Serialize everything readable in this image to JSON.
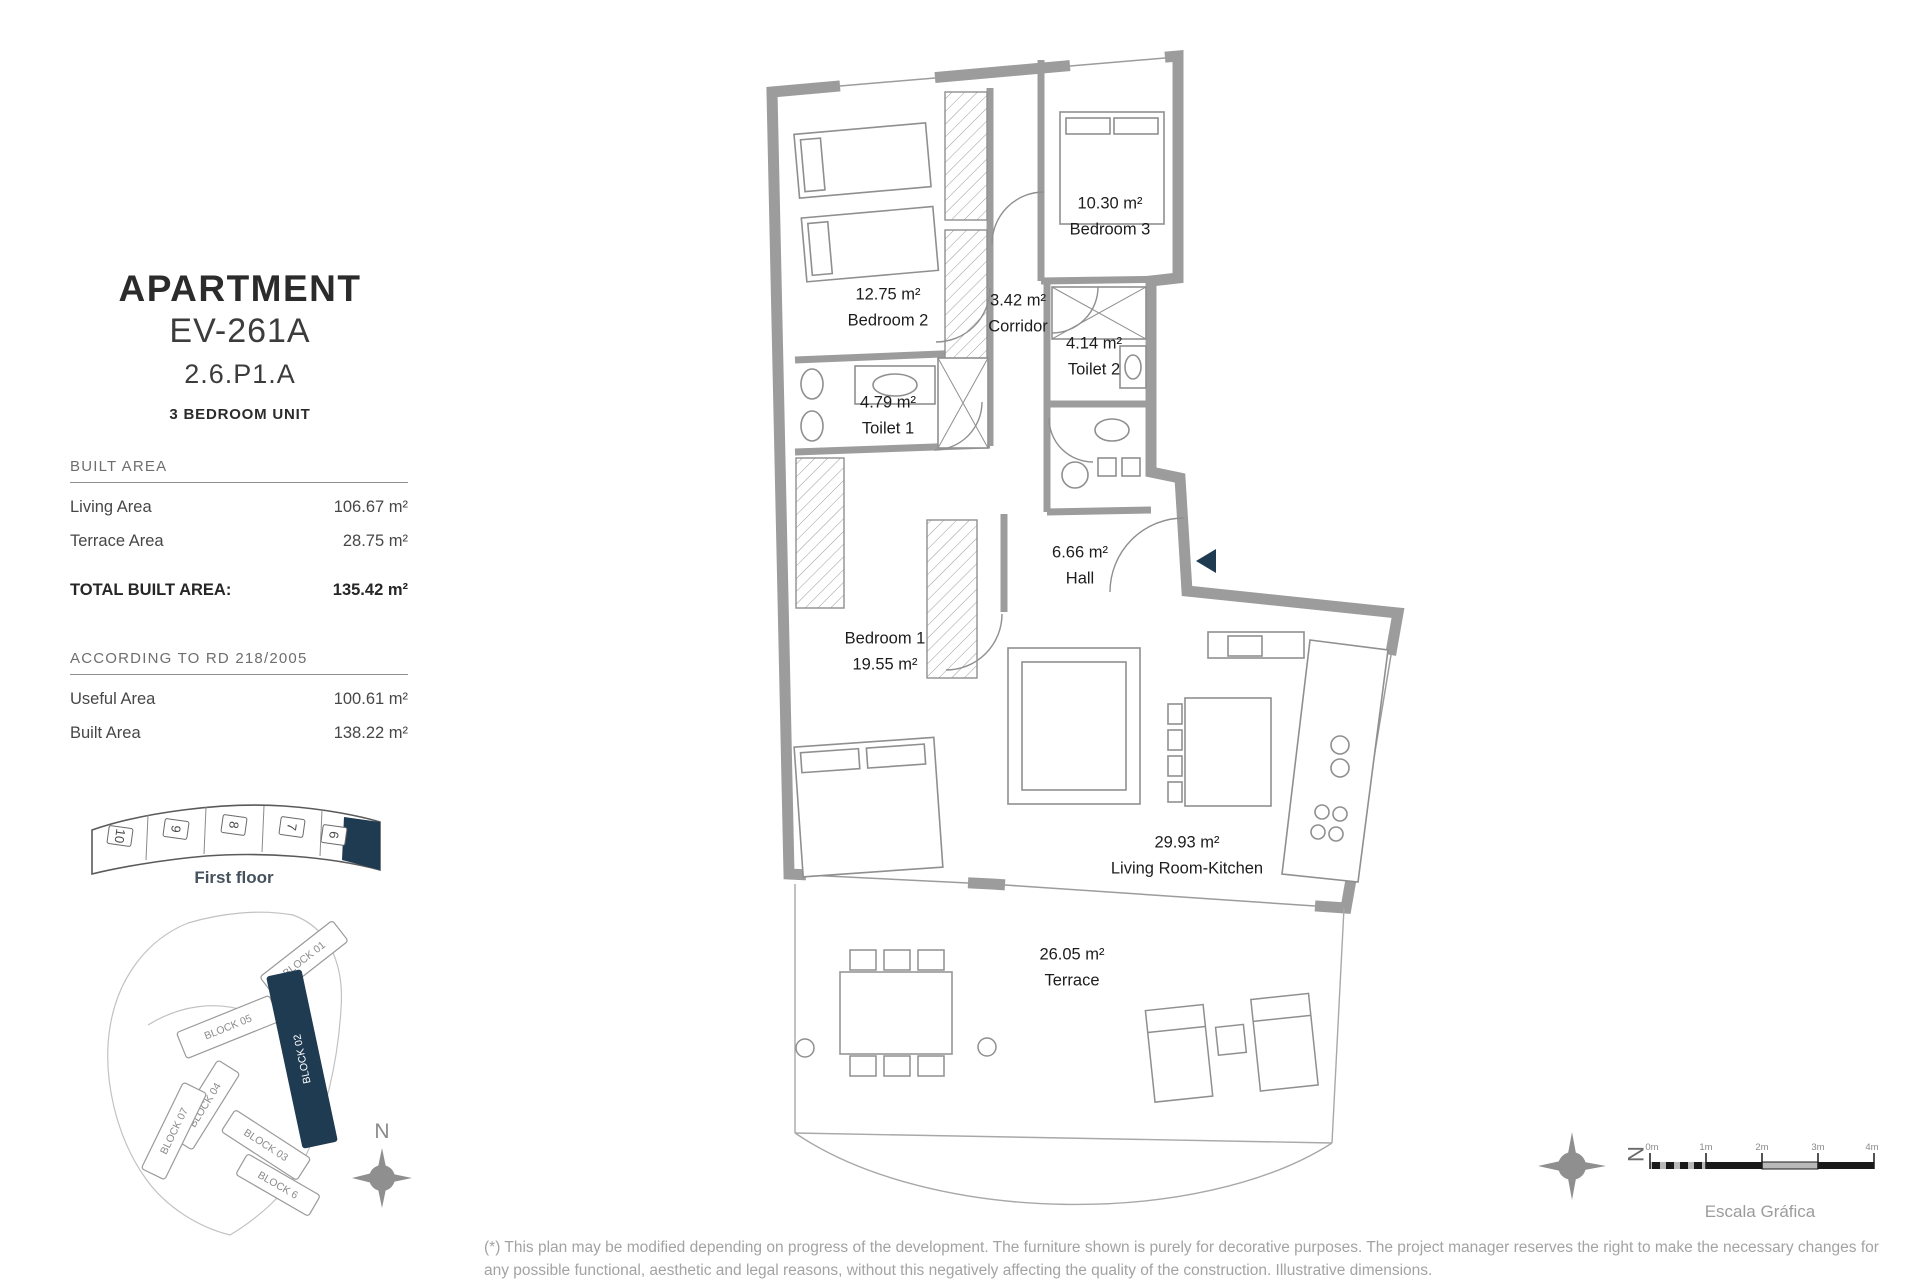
{
  "sidebar": {
    "title": "APARTMENT",
    "unit_code": "EV-261A",
    "unit_ref": "2.6.P1.A",
    "unit_type": "3 BEDROOM UNIT",
    "built_area": {
      "heading": "BUILT AREA",
      "rows": [
        {
          "label": "Living Area",
          "value": "106.67 m²"
        },
        {
          "label": "Terrace Area",
          "value": "28.75 m²"
        }
      ],
      "total_label": "TOTAL BUILT AREA:",
      "total_value": "135.42 m²"
    },
    "rd_area": {
      "heading": "ACCORDING TO RD 218/2005",
      "rows": [
        {
          "label": "Useful Area",
          "value": "100.61 m²"
        },
        {
          "label": "Built Area",
          "value": "138.22 m²"
        }
      ]
    },
    "floor_strip": {
      "caption": "First floor",
      "units": [
        "10",
        "9",
        "8",
        "7",
        "6"
      ],
      "highlighted_unit": "6"
    },
    "site_map": {
      "blocks": [
        "BLOCK 01",
        "BLOCK 02",
        "BLOCK 05",
        "BLOCK 04",
        "BLOCK 07",
        "BLOCK 03",
        "BLOCK 6"
      ],
      "highlighted_block": "BLOCK 02"
    },
    "compass_label": "N"
  },
  "floorplan": {
    "rooms": [
      {
        "area": "10.30 m²",
        "name": "Bedroom 3",
        "x": 1110,
        "y": 217
      },
      {
        "area": "12.75 m²",
        "name": "Bedroom 2",
        "x": 888,
        "y": 308
      },
      {
        "area": "3.42 m²",
        "name": "Corridor",
        "x": 1018,
        "y": 314
      },
      {
        "area": "4.14 m²",
        "name": "Toilet 2",
        "x": 1094,
        "y": 357
      },
      {
        "area": "4.79 m²",
        "name": "Toilet 1",
        "x": 888,
        "y": 416
      },
      {
        "area": "6.66 m²",
        "name": "Hall",
        "x": 1080,
        "y": 566
      },
      {
        "area": "19.55 m²",
        "name": "Bedroom 1",
        "x": 885,
        "y": 652,
        "name_first": true
      },
      {
        "area": "29.93 m²",
        "name": "Living Room-Kitchen",
        "x": 1187,
        "y": 856
      },
      {
        "area": "26.05 m²",
        "name": "Terrace",
        "x": 1072,
        "y": 968
      }
    ]
  },
  "scale_bar": {
    "label": "Escala Gráfica",
    "ticks": [
      "0m",
      "1m",
      "2m",
      "3m",
      "4m"
    ],
    "compass_label": "N"
  },
  "footer": {
    "text": "(*) This plan may be modified depending on progress of the development. The furniture shown is purely for decorative purposes. The project manager reserves the right to make the necessary changes for any possible functional, aesthetic and legal reasons, without this negatively affecting the quality of the construction. Illustrative dimensions."
  },
  "colors": {
    "accent_navy": "#1f3b52",
    "wall_gray": "#9c9c9c"
  }
}
